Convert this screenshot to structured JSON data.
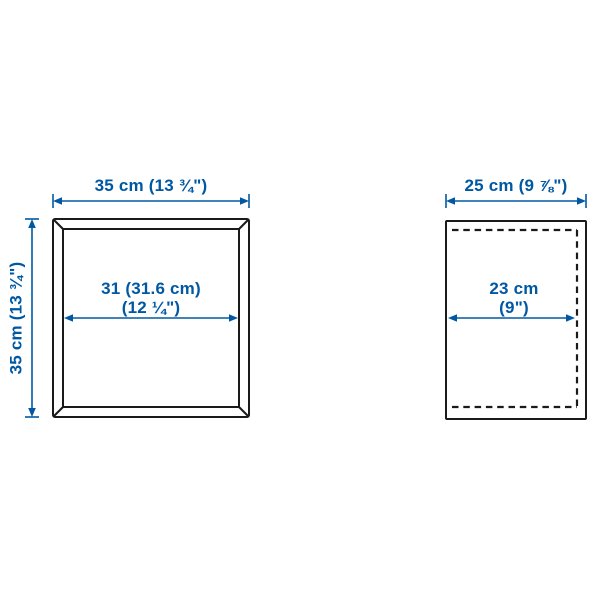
{
  "colors": {
    "accent_blue": "#0058a3",
    "line_dark": "#1a1a1a",
    "background": "#ffffff"
  },
  "front_view": {
    "width_label": "35 cm (13 ¾\")",
    "height_label": "35 cm (13 ¾\")",
    "inner_width_line1": "31 (31.6 cm)",
    "inner_width_line2": "(12 ¼\")"
  },
  "side_view": {
    "depth_label": "25 cm (9 ⅞\")",
    "inner_depth_line1": "23 cm",
    "inner_depth_line2": "(9\")"
  }
}
